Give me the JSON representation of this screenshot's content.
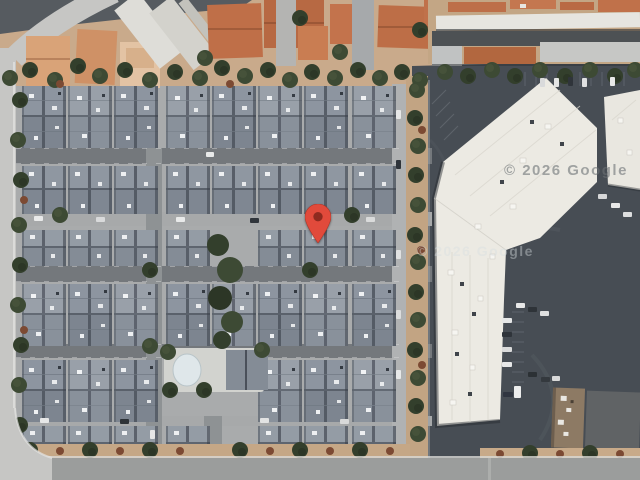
{
  "view": {
    "type": "satellite-map",
    "attribution": {
      "watermark_1": "© 2026 Google",
      "watermark_2": "© 2026 Google"
    },
    "marker": {
      "name": "dropped-pin",
      "tip_x": 318,
      "tip_y": 242,
      "body_color": "#E14A3B",
      "dot_color": "#8E2A1F"
    },
    "palette": {
      "condo_roof_gray": "#828A94",
      "terracotta_roof": "#BF6F48",
      "commercial_roof_white": "#ECEAE3",
      "parking_asphalt": "#474D54",
      "residential_street": "#74787C",
      "perimeter_road": "#C6C6C4",
      "dirt_tan": "#C5A786",
      "tree_green": "#3D4A34",
      "pool_water": "#DFE7EA"
    }
  }
}
